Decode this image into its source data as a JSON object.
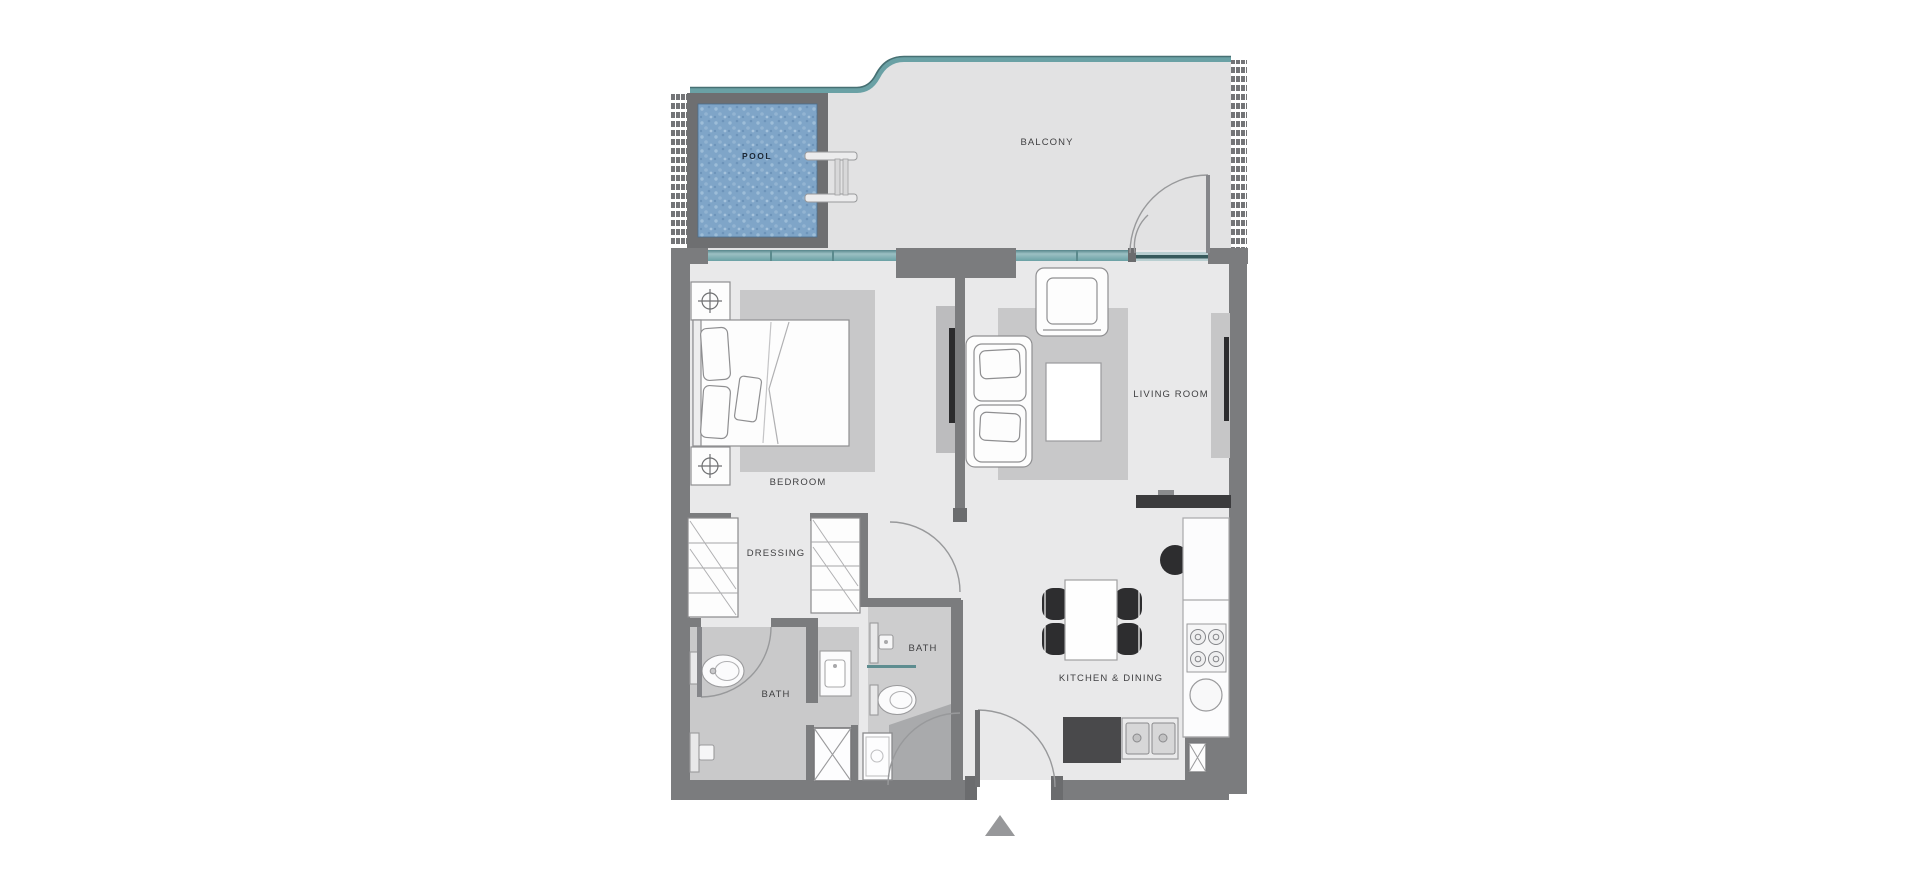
{
  "plan": {
    "rooms": {
      "pool": {
        "label": "POOL"
      },
      "balcony": {
        "label": "BALCONY"
      },
      "bedroom": {
        "label": "BEDROOM"
      },
      "living_room": {
        "label": "LIVING ROOM"
      },
      "dressing": {
        "label": "DRESSING"
      },
      "bath_1": {
        "label": "BATH"
      },
      "bath_2": {
        "label": "BATH"
      },
      "kitchen_dining": {
        "label": "KITCHEN & DINING"
      }
    },
    "colors": {
      "wall_gray": "#7b7c7e",
      "glass_teal": "#6aa1a5",
      "glass_teal_dark": "#477073",
      "pool_water_blue": "#7fa5c8",
      "floor_unit": "#e9e9ea",
      "floor_balcony": "#e2e2e3",
      "floor_bath": "#c9c9ca",
      "rug_gray": "#c8c8c9",
      "furniture_dark": "#2d2d2f",
      "counter_dark": "#49494b"
    }
  }
}
